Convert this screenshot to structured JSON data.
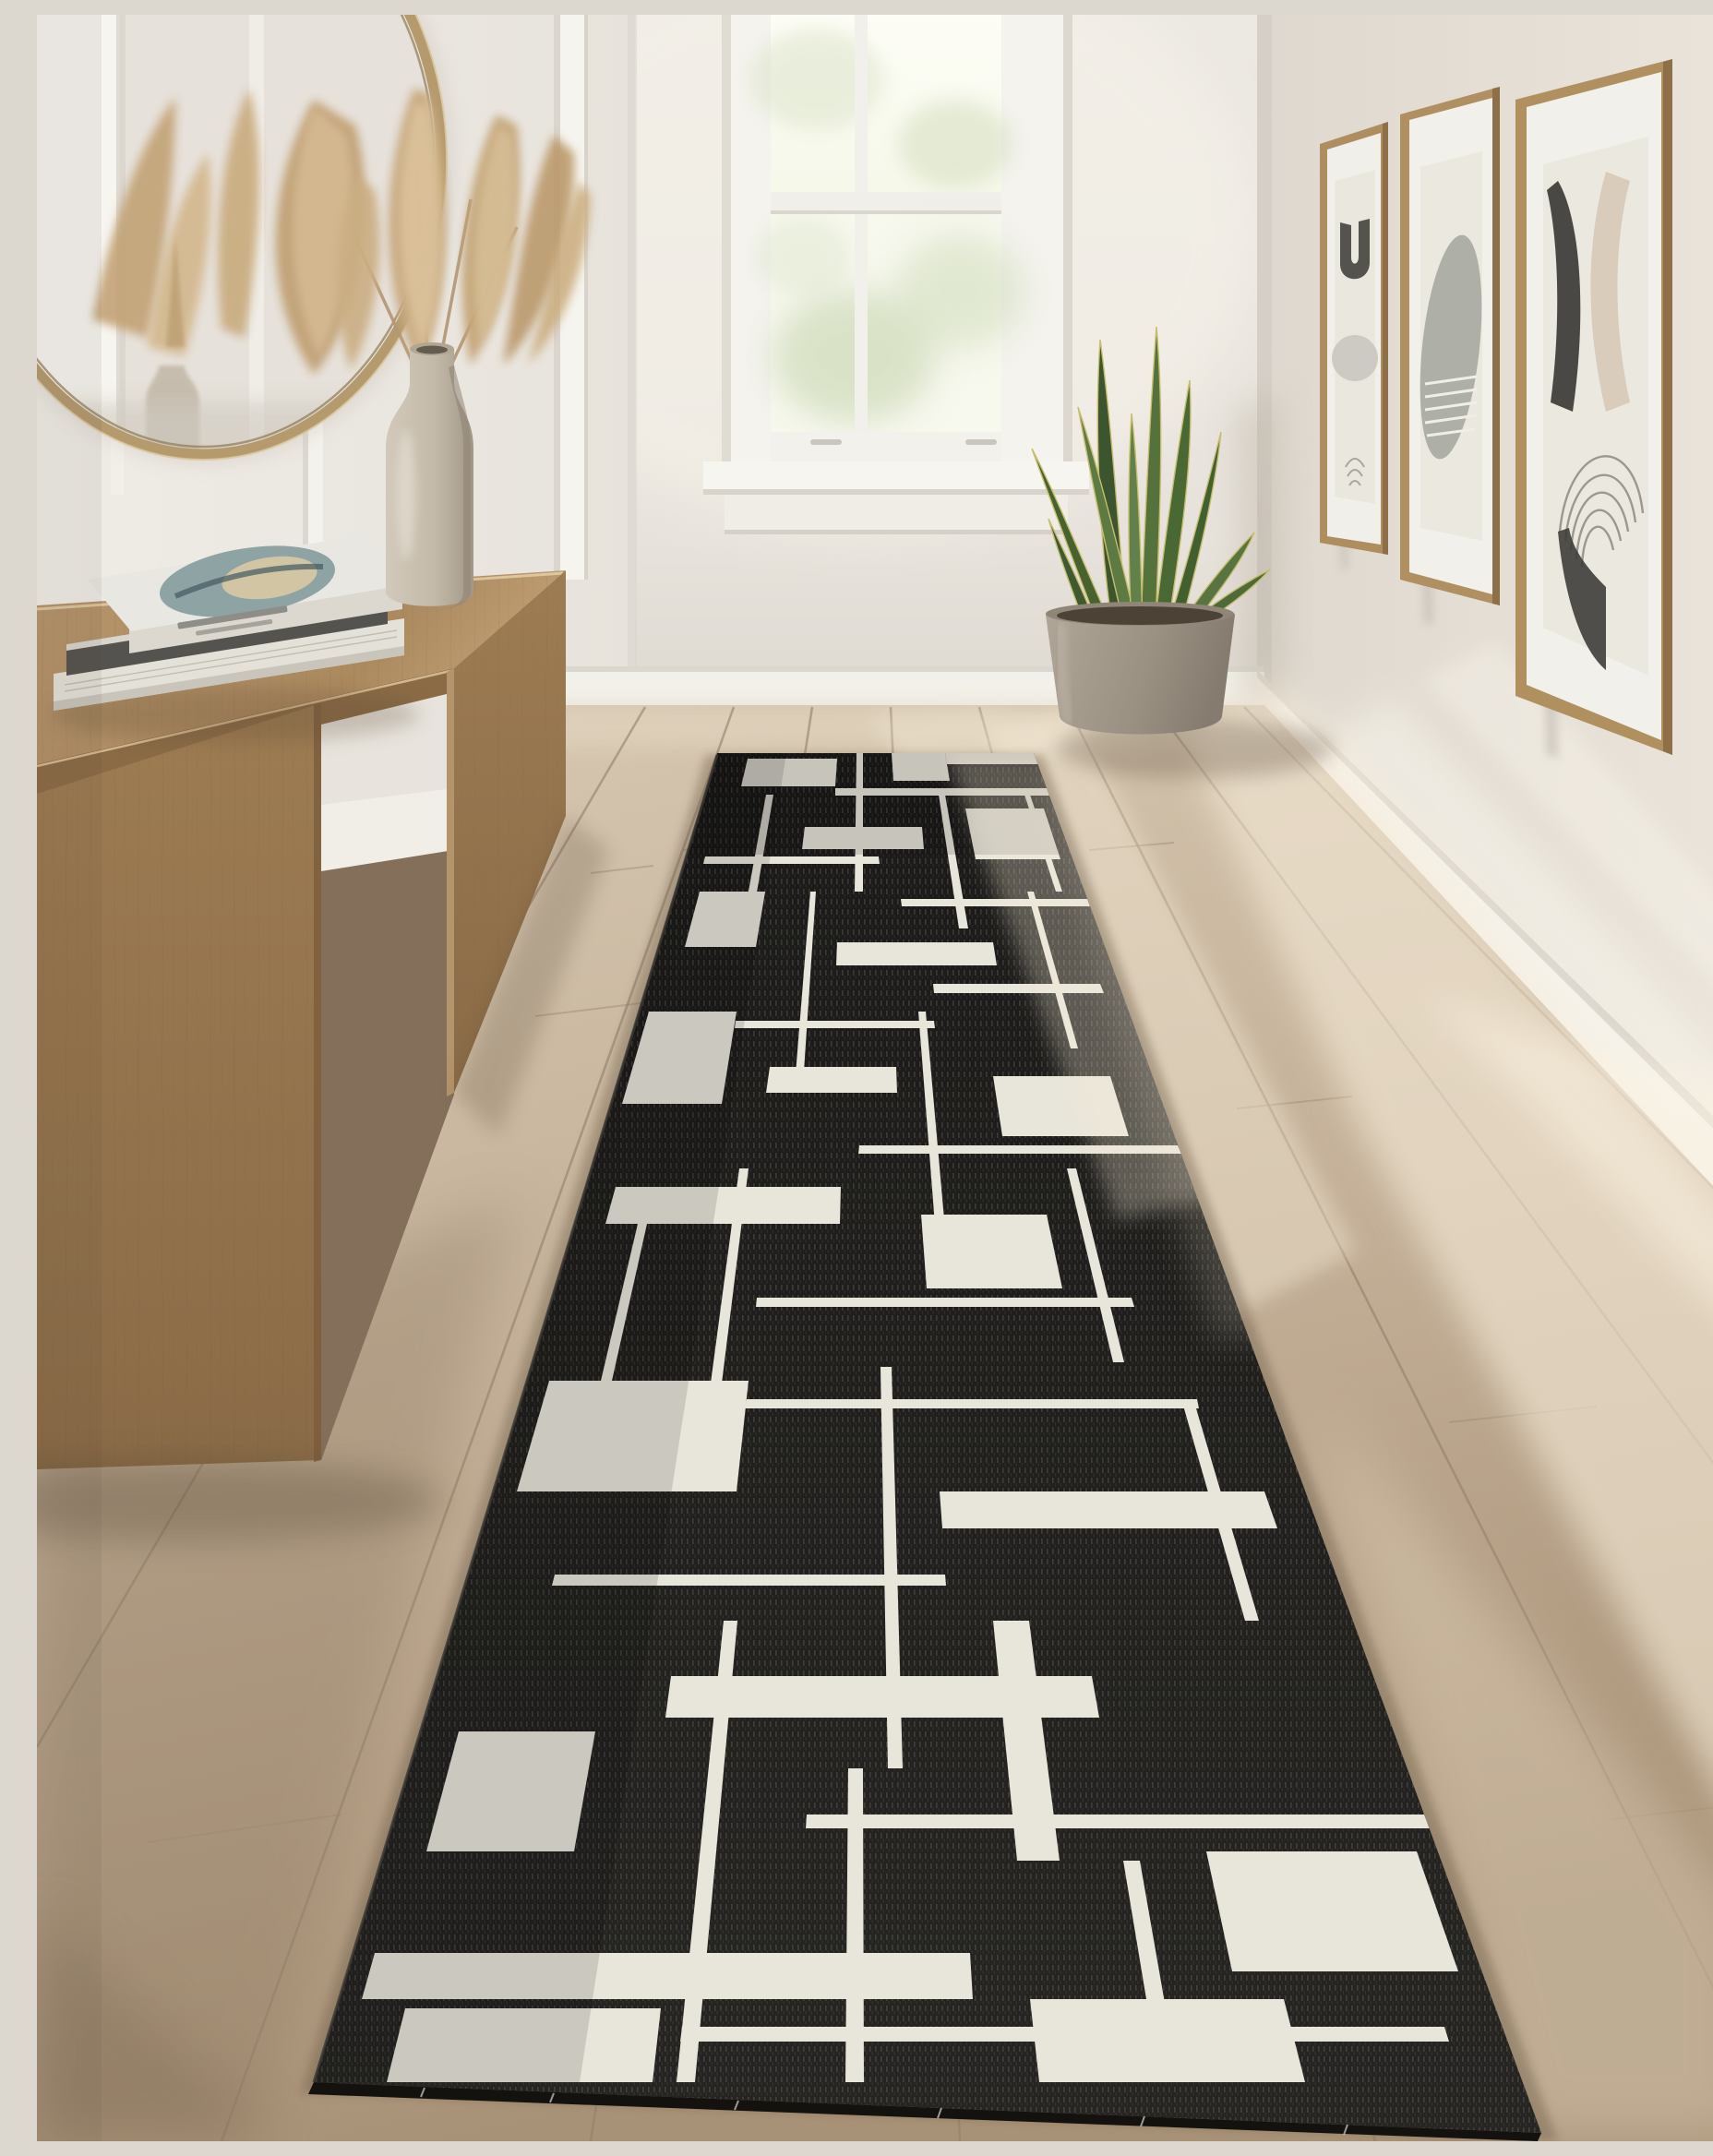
{
  "meta": {
    "title": "Sunlit hallway interior with a black and ivory geometric runner rug",
    "media_type": "photograph"
  },
  "scene": {
    "labels": {
      "scene": "Hallway interior photograph",
      "left_wall": "White panelled left wall with battens",
      "back_wall": "White back wall with window",
      "right_wall": "Sunlit right wall with gallery frames",
      "mirror": "Round brass-framed mirror reflecting pampas grass",
      "pampas_vase": "Stone bottle vase holding dried pampas grass plumes",
      "console": "Light walnut parsons-style console table",
      "books": "Stack of three coffee-table books",
      "window": "White double-hung window with green foliage outside",
      "plant": "Snake plant in a round concrete pot",
      "art_group": "Three oak-framed abstract mid-century prints",
      "art_1": "Print with dark arch and grey circle",
      "art_2": "Print with grey oval and line hatching",
      "art_3": "Print with concentric arcs and dark blade shape",
      "rug": "Black and ivory Mondrian-style geometric runner rug",
      "floor": "Light oak plank floor with diagonal sunlight",
      "baseboard": "White baseboard trim",
      "sunlight": "Diagonal sunlight streaks"
    },
    "palette": {
      "wall": "#e9e5df",
      "wall_left": "#edeae4",
      "wall_right": "#e2ddd5",
      "trim_white": "#f3f1ec",
      "floor_base": "#c9b7a0",
      "floor_dark": "#a8937a",
      "floor_sunlit": "#f4ebd9",
      "wood_front": "#96764f",
      "wood_top": "#b3926a",
      "rug_black": "#201f1c",
      "rug_ivory": "#e8e5da",
      "brass": "#b59a6e",
      "leaf_green_dark": "#3c552f",
      "leaf_green_mid": "#55713c",
      "pampas_tan": "#c7a97f",
      "pot_grey": "#9d9386",
      "frame_oak": "#ae8d5f",
      "glass_glow": "#fbfcf2",
      "foliage_green": "#c9d6b0"
    }
  }
}
